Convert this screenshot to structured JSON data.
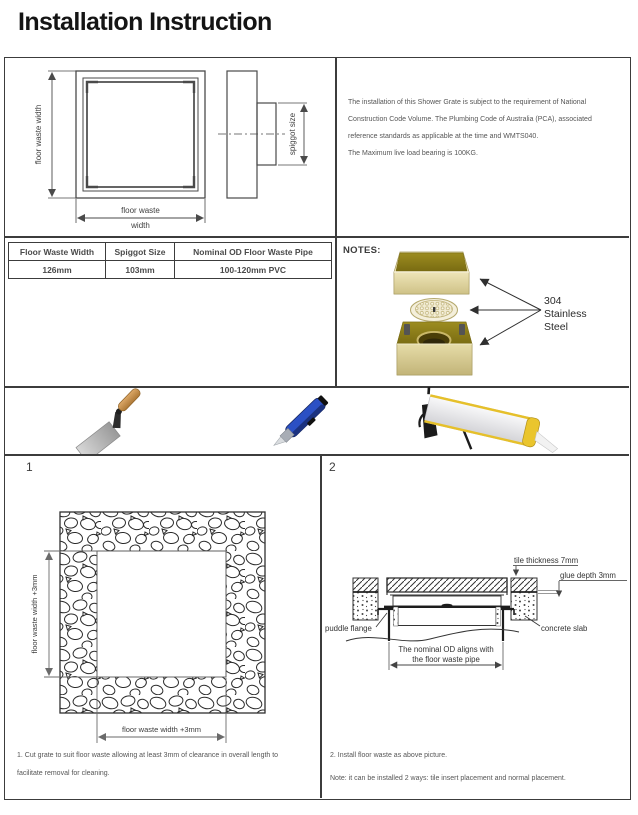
{
  "title": "Installation Instruction",
  "intro": {
    "lines": [
      "The installation of this Shower Grate is subject to the requirement of National",
      "Construction Code Volume. The Plumbing Code of Australia (PCA), associated",
      "reference standards as applicable at the time and WMTS040.",
      "The Maximum live load bearing is 100KG."
    ]
  },
  "drawing": {
    "floor_waste_width_vertical": "floor waste width",
    "floor_waste_line1": "floor waste",
    "floor_waste_line2": "width",
    "spiggot_size": "spiggot size"
  },
  "spec_table": {
    "headers": [
      "Floor Waste Width",
      "Spiggot Size",
      "Nominal OD Floor Waste Pipe"
    ],
    "values": [
      "126mm",
      "103mm",
      "100-120mm PVC"
    ]
  },
  "notes": {
    "label": "NOTES:",
    "material_lines": [
      "304",
      "Stainless",
      "Steel"
    ]
  },
  "tools": {
    "items": [
      "trowel",
      "utility-knife",
      "caulking-gun"
    ]
  },
  "steps": {
    "one": {
      "number": "1",
      "dim_left": "floor waste width +3mm",
      "dim_bottom": "floor waste width +3mm",
      "note_line1": "1. Cut grate to suit floor waste allowing at least 3mm of clearance in overall length to",
      "note_line2": "facilitate removal for cleaning."
    },
    "two": {
      "number": "2",
      "tile_thickness": "tile thickness 7mm",
      "glue_depth": "glue depth 3mm",
      "puddle_flange": "puddle flange",
      "concrete_slab": "concrete slab",
      "nominal_line1": "The nominal OD aligns with",
      "nominal_line2": "the floor waste pipe",
      "note1": "2. Install floor waste as above picture.",
      "note2": "Note: it can be installed 2 ways: tile insert placement and normal placement."
    }
  },
  "colors": {
    "line": "#3c3c3c",
    "brass_dark": "#8c7d1a",
    "brass_light": "#e9e0b0",
    "knife_blue": "#2b50c4",
    "gun_yellow": "#eac52d"
  }
}
